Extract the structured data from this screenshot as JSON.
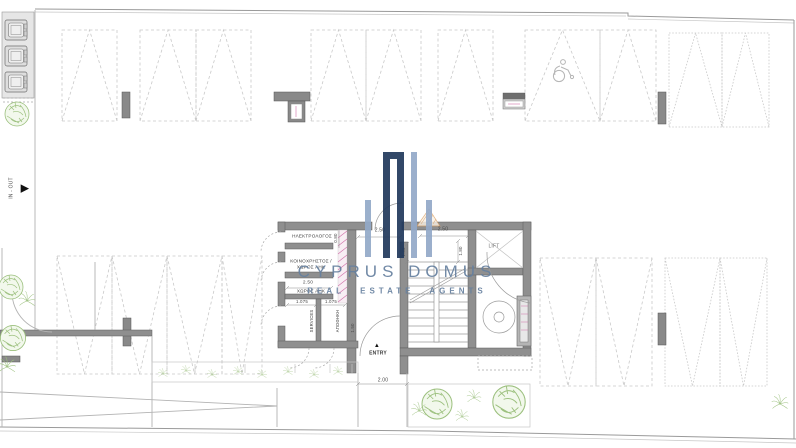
{
  "plan": {
    "rooms": {
      "electrician": "ΗΛΕΚΤΡΟΛΟΓΟΣ",
      "communal_line1": "ΚΟΙΝΟΧΡΗΣΤΟΣ /",
      "communal_line2": "ΧΩΡΟΣ ΑΗΚ",
      "eac_room": "ΧΩΡΟΣ ΑΗΚ",
      "storage_left": "SERVICES",
      "storage_right": "ΑΠΟΘΗΚΗ",
      "lift": "LIFT"
    },
    "markers": {
      "entry": "ENTRY",
      "in_out": "IN - OUT"
    },
    "dimensions": {
      "corridor_width": "2.50",
      "lobby_width": "2.50",
      "corridor_depth": "1.35",
      "lobby_depth": "1.80",
      "elec_depth": "0.80",
      "eac_width": "2.50",
      "storage1_width": "1.075",
      "storage2_width": "1.075",
      "storage_depth": "1.50",
      "walkway_width": "2.00"
    }
  },
  "watermark": {
    "title": "CYPRUS DOMUS",
    "subtitle": "REAL ESTATE AGENTS"
  },
  "icons": {
    "entry_arrow": "▲",
    "in_out_arrow": "▶",
    "disabled_parking": "wheelchair",
    "waste_bins": "bins",
    "tree": "tree"
  },
  "colors": {
    "wall": "#8f8f8f",
    "parking_dash": "#c9c9c9",
    "plant": "#9cc07e",
    "watermark_navy": "#21395c",
    "watermark_blue": "#93a9c8",
    "watermark_text": "#66809f",
    "hatch_pink": "#d06fa8",
    "hatch_tan": "#d9a066"
  }
}
